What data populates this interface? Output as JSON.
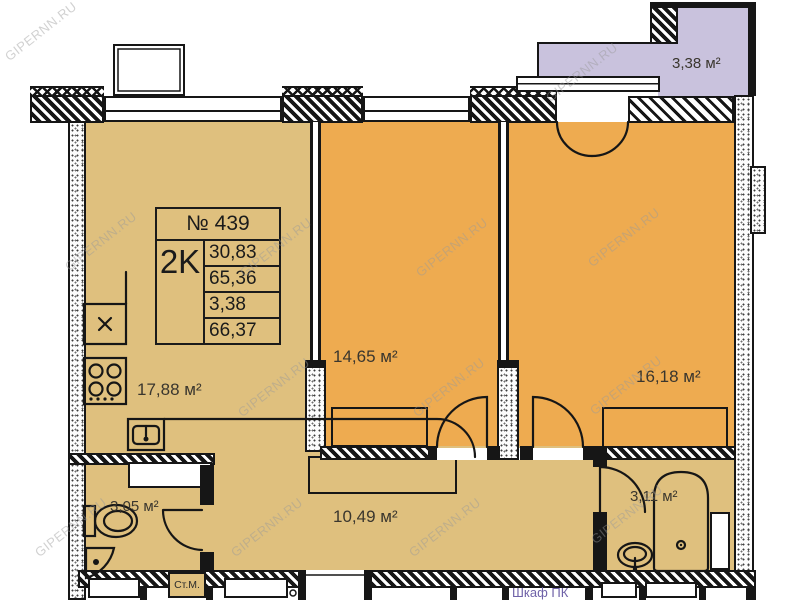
{
  "watermark_text": "GIPERNN.RU",
  "info_table": {
    "number": "№ 439",
    "type": "2K",
    "values": [
      "30,83",
      "65,36",
      "3,38",
      "66,37"
    ]
  },
  "rooms": {
    "kitchen": "17,88 м²",
    "room1": "14,65 м²",
    "room2": "16,18 м²",
    "hallway": "10,49 м²",
    "bathroom1": "3,05 м²",
    "bathroom2": "3,11 м²",
    "balcony": "3,38 м²"
  },
  "annotations": {
    "washing_machine": "Ст.М.",
    "closet": "Шкаф ПК"
  },
  "colors": {
    "room_fill": "#eeab50",
    "service_fill": "#dfc07e",
    "balcony_fill": "#c9c2dd",
    "wall": "#161616",
    "closet_label": "#6f62a8",
    "watermark_gray": "#9a9a9a"
  }
}
